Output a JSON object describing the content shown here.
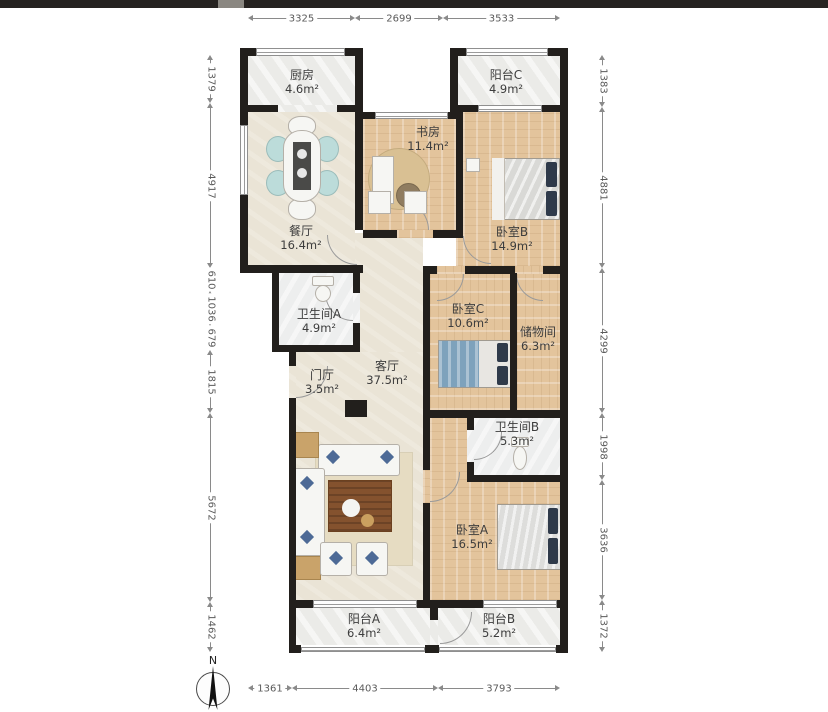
{
  "plan_type": "apartment-floor-plan",
  "compass": {
    "label": "N"
  },
  "rooms": [
    {
      "name": "厨房",
      "area": "4.6m²"
    },
    {
      "name": "阳台C",
      "area": "4.9m²"
    },
    {
      "name": "书房",
      "area": "11.4m²"
    },
    {
      "name": "卧室B",
      "area": "14.9m²"
    },
    {
      "name": "餐厅",
      "area": "16.4m²"
    },
    {
      "name": "卫生间A",
      "area": "4.9m²"
    },
    {
      "name": "卧室C",
      "area": "10.6m²"
    },
    {
      "name": "储物间",
      "area": "6.3m²"
    },
    {
      "name": "门厅",
      "area": "3.5m²"
    },
    {
      "name": "客厅",
      "area": "37.5m²"
    },
    {
      "name": "卫生间B",
      "area": "5.3m²"
    },
    {
      "name": "卧室A",
      "area": "16.5m²"
    },
    {
      "name": "阳台A",
      "area": "6.4m²"
    },
    {
      "name": "阳台B",
      "area": "5.2m²"
    }
  ],
  "dims": {
    "top": [
      "3325",
      "2699",
      "3533"
    ],
    "bottom": [
      "1361",
      "4403",
      "3793"
    ],
    "left": [
      "1379",
      "4917",
      "610",
      "1036",
      "679",
      "1815",
      "5672",
      "1462"
    ],
    "right": [
      "1383",
      "4881",
      "4299",
      "1998",
      "3636",
      "1372"
    ]
  },
  "colors": {
    "wall": "#221f1c",
    "wood": "#e3c49c",
    "beige": "#eae4d6",
    "floor_gray": "#ebebe8",
    "bath": "#edeeee",
    "accent_teal": "#bcdcda",
    "bed_blue": "#7ea2bc",
    "pillow_navy": "#2f3a4a",
    "table_brown": "#84522e",
    "rug": "#e6dcc2",
    "tan": "#c9a36a",
    "dim": "#8a8a8a",
    "label": "#3d3d3d",
    "strip": "#262321"
  }
}
